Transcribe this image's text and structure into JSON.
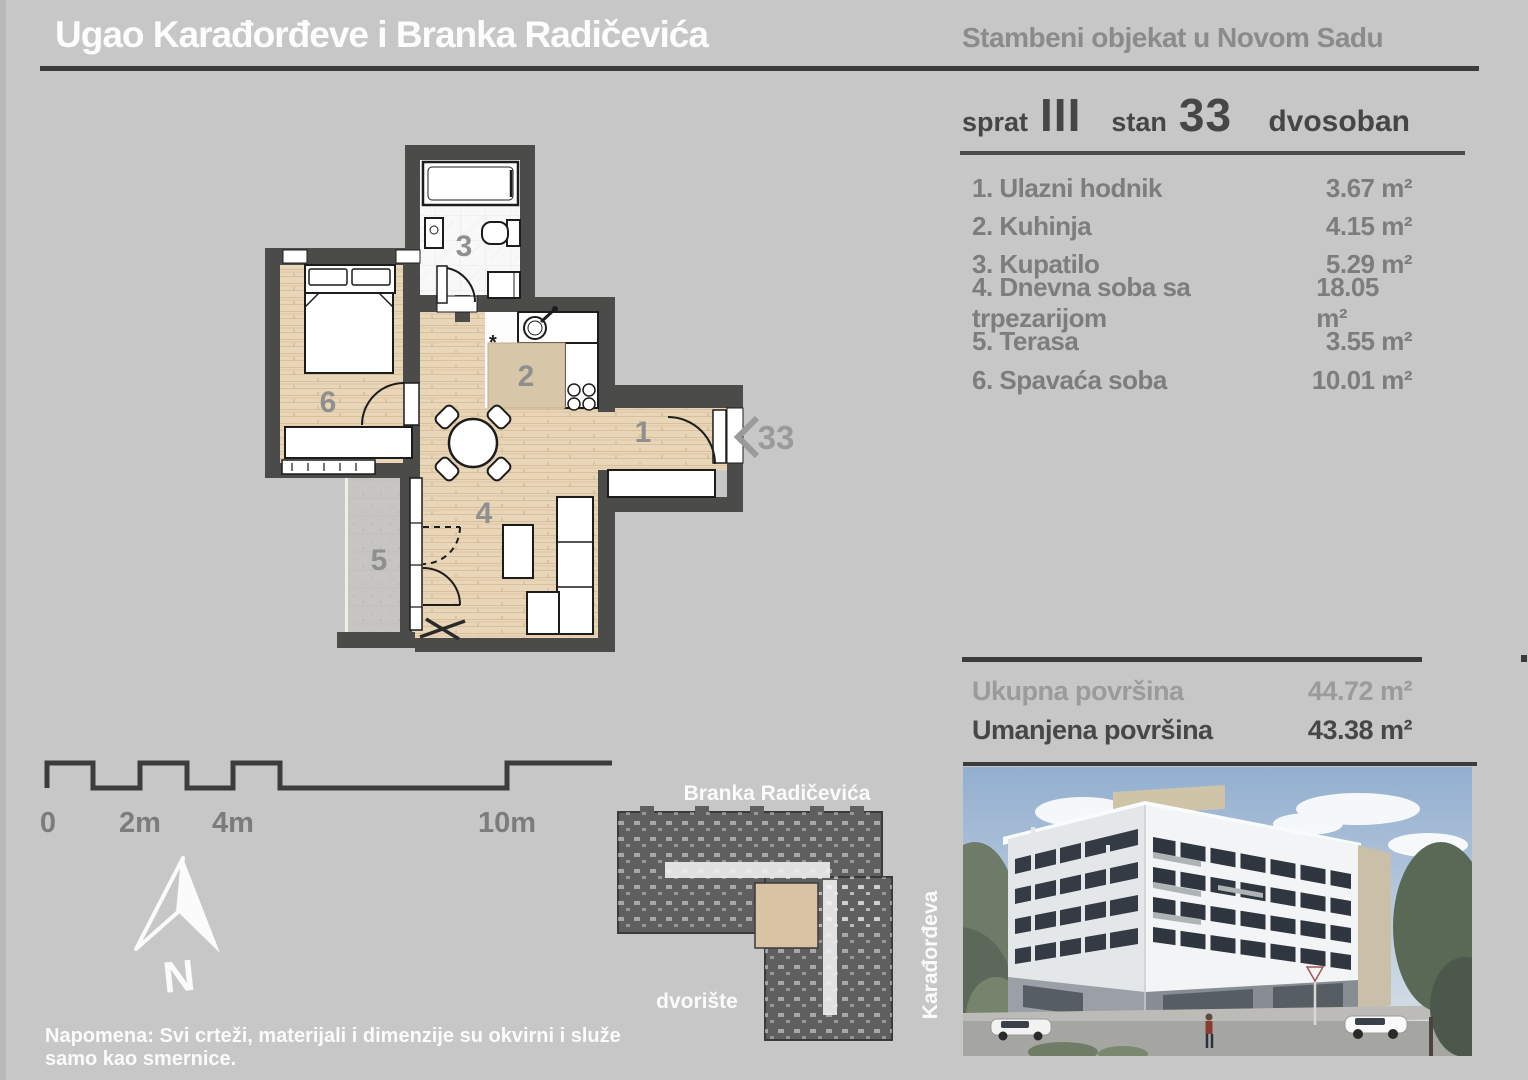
{
  "header": {
    "title": "Ugao Karađorđeve i Branka Radičevića",
    "subtitle": "Stambeni objekat u Novom Sadu"
  },
  "unit": {
    "floor_label": "sprat",
    "floor_value": "III",
    "apartment_label": "stan",
    "apartment_value": "33",
    "type": "dvosoban"
  },
  "rooms": [
    {
      "name": "1. Ulazni hodnik",
      "area": "3.67 m²"
    },
    {
      "name": "2. Kuhinja",
      "area": "4.15 m²"
    },
    {
      "name": "3. Kupatilo",
      "area": "5.29 m²"
    },
    {
      "name": "4. Dnevna soba sa trpezarijom",
      "area": "18.05 m²"
    },
    {
      "name": "5. Terasa",
      "area": "3.55 m²"
    },
    {
      "name": "6. Spavaća soba",
      "area": "10.01 m²"
    }
  ],
  "totals": {
    "gross_label": "Ukupna površina",
    "gross_value": "44.72 m²",
    "net_label": "Umanjena površina",
    "net_value": "43.38 m²"
  },
  "plan": {
    "hall_number": "1",
    "kitchen_number": "2",
    "bath_number": "3",
    "living_number": "4",
    "terrace_number": "5",
    "bedroom_number": "6",
    "entrance_number": "33",
    "kitchen_note": "*"
  },
  "scalebar": {
    "labels": [
      "0",
      "2m",
      "4m",
      "10m"
    ]
  },
  "compass": {
    "north": "N"
  },
  "siteplan": {
    "street_top": "Branka Radičevića",
    "street_right": "Karađorđeva",
    "courtyard": "dvorište"
  },
  "note": "Napomena: Svi crteži, materijali i dimenzije su okvirni i služe samo kao smernice.",
  "colors": {
    "background": "#c7c7c7",
    "wall": "#4b4b49",
    "rule_dark": "#3c3c3c",
    "text_gray": "#7d7d7d",
    "wood_floor": "#e9d5b8",
    "highlight_unit": "#d8c3a5"
  }
}
